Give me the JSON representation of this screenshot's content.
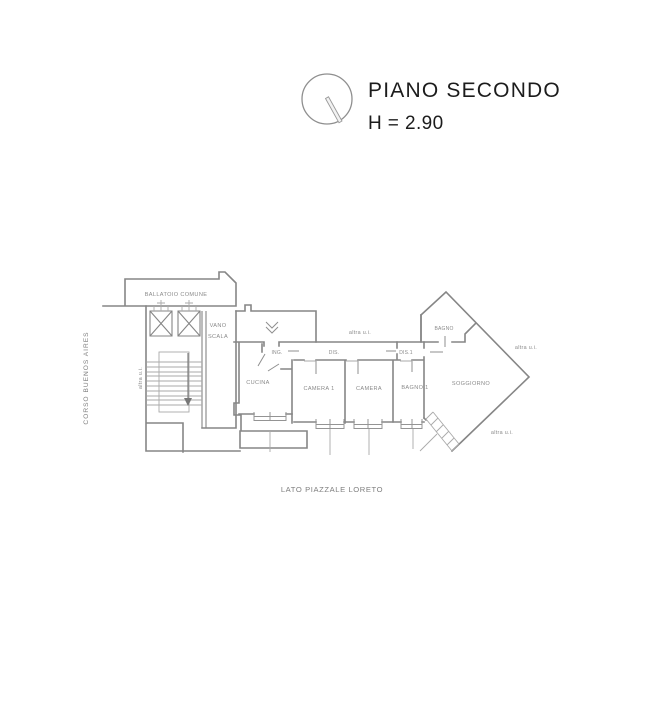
{
  "title": {
    "name": "PIANO SECONDO",
    "height": "H = 2.90"
  },
  "plan": {
    "streets": {
      "left": "CORSO BUENOS AIRES",
      "bottom": "LATO PIAZZALE LORETO"
    },
    "common_areas": {
      "ballatoio": "BALLATOIO COMUNE",
      "vano_scala_line1": "VANO",
      "vano_scala_line2": "SCALA"
    },
    "rooms": {
      "cucina": "CUCINA",
      "camera1": "CAMERA 1",
      "camera": "CAMERA",
      "bagno1": "BAGNO 1",
      "bagno": "BAGNO",
      "soggiorno": "SOGGIORNO",
      "ing": "ING.",
      "dis": "DIS.",
      "dis1": "DIS.1"
    },
    "annotations": {
      "altra_ui_top": "altra u.i.",
      "altra_ui_right": "altra u.i.",
      "altra_ui_bottom": "altra u.i.",
      "altra_ui_stairs": "altra u.i."
    },
    "colors": {
      "wall": "#868686",
      "thin": "#aaaaaa",
      "label": "#8a8a8a",
      "title": "#1c1c1c",
      "bg": "#ffffff"
    }
  }
}
